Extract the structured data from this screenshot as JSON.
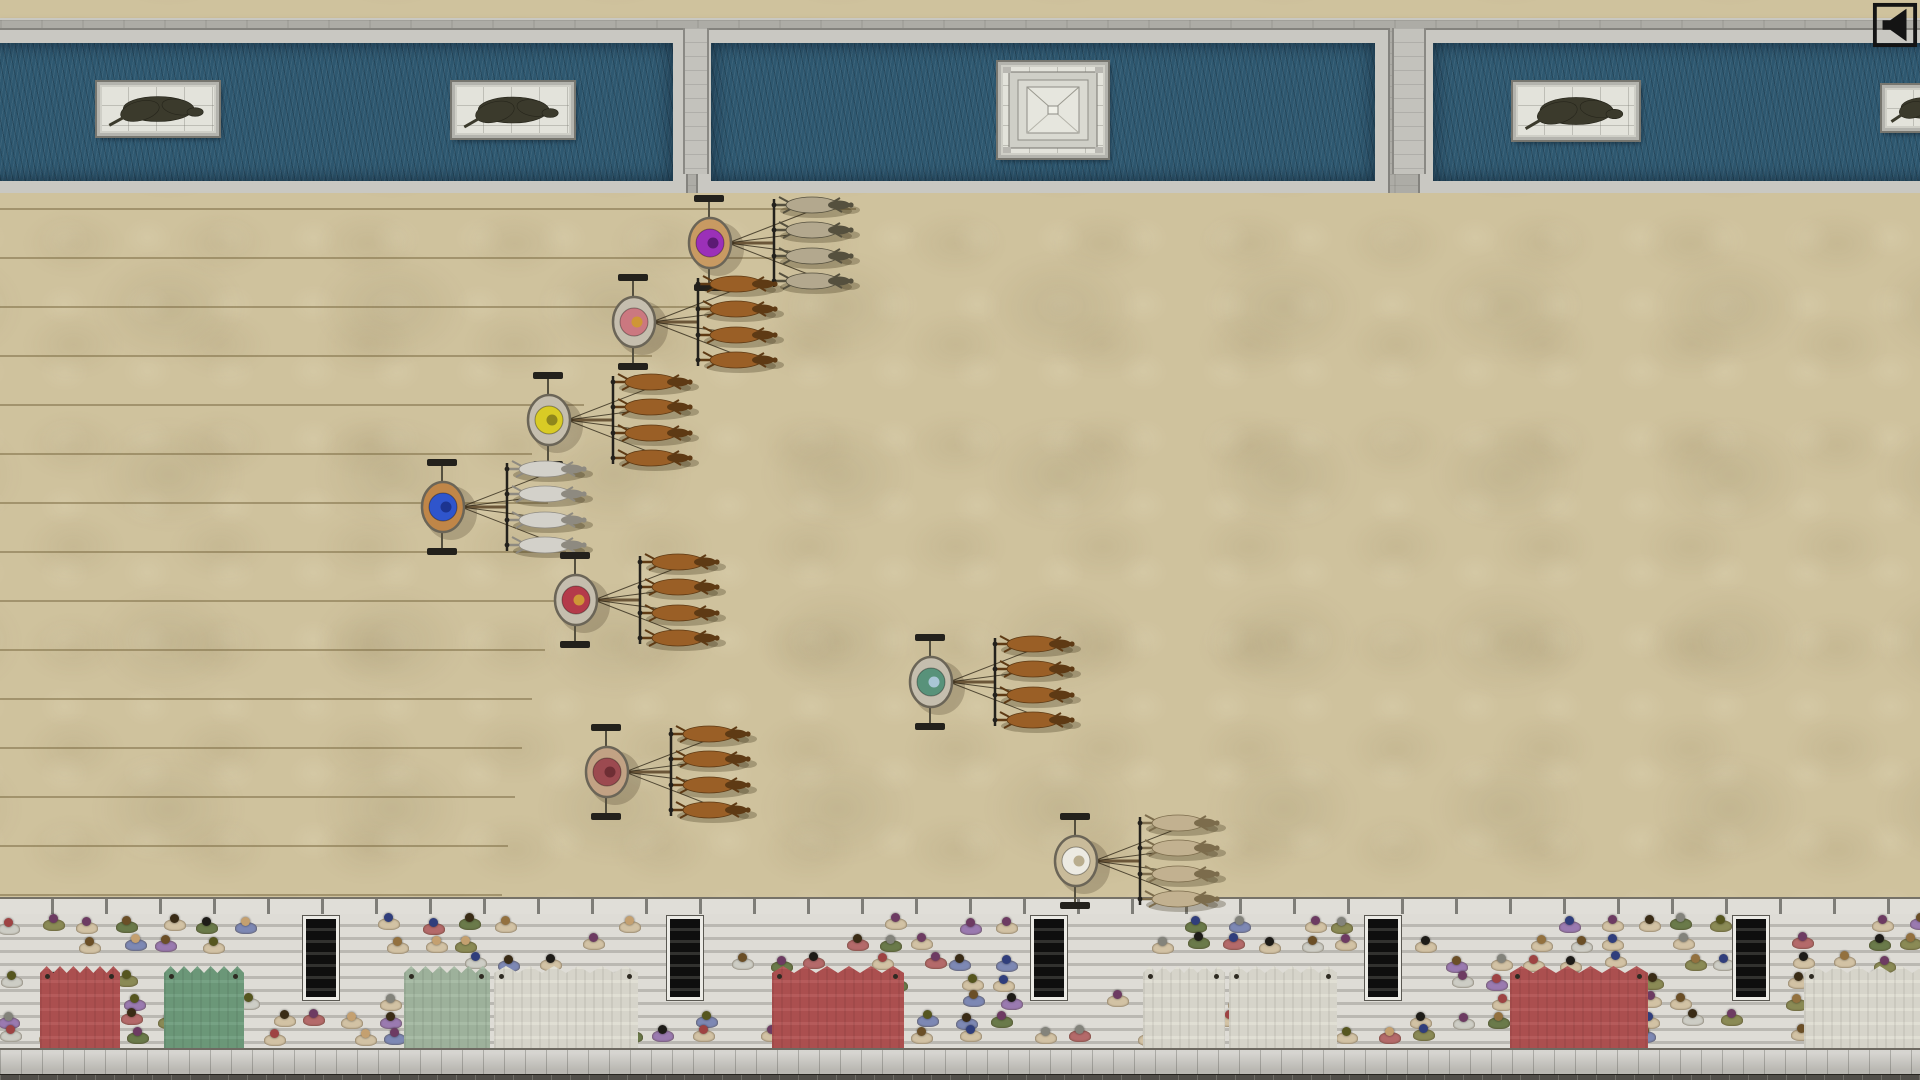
{
  "meta": {
    "scene": "top-down chariot race in a roman circus"
  },
  "colors": {
    "sand": "#cfc29d",
    "water": "#2e5870",
    "marble": "#c9c8c2",
    "spina_stone": "#adaca6",
    "stand_step": "#d7d5cf",
    "banner_red": "#b25252",
    "banner_green": "#6f9d7d",
    "banner_pale_green": "#a3b8a1",
    "banner_white": "#dfddd2",
    "statue_bronze": "#3b3a2c",
    "lane_line": "#7d6e46"
  },
  "hud": {
    "mute_button": {
      "icon": "speaker-icon",
      "x": 1872,
      "y": 2,
      "size": 46
    }
  },
  "spina": {
    "pools": [
      {
        "x": -80,
        "width": 770
      },
      {
        "x": 698,
        "width": 694
      },
      {
        "x": 1420,
        "width": 560
      }
    ],
    "junctions": [
      {
        "x": 683,
        "width": 22
      },
      {
        "x": 1392,
        "width": 30
      }
    ],
    "monuments": [
      {
        "kind": "statue",
        "name": "equestrian-statue",
        "x": 97,
        "y": 62,
        "w": 116,
        "h": 48
      },
      {
        "kind": "statue",
        "name": "standing-statue",
        "x": 452,
        "y": 62,
        "w": 116,
        "h": 50
      },
      {
        "kind": "obelisk",
        "name": "pyramid-monument",
        "x": 998,
        "y": 42,
        "w": 104,
        "h": 90
      },
      {
        "kind": "statue",
        "name": "reclining-statue",
        "x": 1513,
        "y": 62,
        "w": 120,
        "h": 52
      },
      {
        "kind": "statue",
        "name": "edge-statue",
        "x": 1882,
        "y": 65,
        "w": 80,
        "h": 40
      }
    ]
  },
  "track": {
    "lane_lines": {
      "ys": [
        208,
        257,
        306,
        355,
        404,
        453,
        502,
        551,
        600,
        649,
        698,
        747,
        796,
        845,
        894
      ],
      "end_xs": [
        856,
        788,
        720,
        652,
        584,
        532,
        548,
        566,
        584,
        545,
        532,
        522,
        515,
        508,
        502
      ]
    }
  },
  "chariots": [
    {
      "team": "purple",
      "cart_x": 710,
      "cart_y": 243,
      "driver_color": "#9b30b8",
      "head_color": "#5c1a74",
      "cart_color": "#c89a62",
      "horse_color": "#b3a88e",
      "horse_dark": "#55503e"
    },
    {
      "team": "rose",
      "cart_x": 634,
      "cart_y": 322,
      "driver_color": "#cb7880",
      "head_color": "#cf9636",
      "cart_color": "#c5beae",
      "horse_color": "#9a5f26",
      "horse_dark": "#5e3a14"
    },
    {
      "team": "yellow",
      "cart_x": 549,
      "cart_y": 420,
      "driver_color": "#d9cb25",
      "head_color": "#8f861c",
      "cart_color": "#c5beae",
      "horse_color": "#9a5f26",
      "horse_dark": "#5e3a14"
    },
    {
      "team": "blue",
      "cart_x": 443,
      "cart_y": 507,
      "driver_color": "#2f55cc",
      "head_color": "#1c3490",
      "cart_color": "#c08648",
      "horse_color": "#d3d1ca",
      "horse_dark": "#8e8a80"
    },
    {
      "team": "red",
      "cart_x": 576,
      "cart_y": 600,
      "driver_color": "#b43a4a",
      "head_color": "#cf9636",
      "cart_color": "#c5beae",
      "horse_color": "#9a5f26",
      "horse_dark": "#5e3a14"
    },
    {
      "team": "green",
      "cart_x": 931,
      "cart_y": 682,
      "driver_color": "#58927a",
      "head_color": "#a9c6d6",
      "cart_color": "#c5beae",
      "horse_color": "#9a5f26",
      "horse_dark": "#5e3a14"
    },
    {
      "team": "maroon",
      "cart_x": 607,
      "cart_y": 772,
      "driver_color": "#9c4a50",
      "head_color": "#6e2e34",
      "cart_color": "#c2a284",
      "horse_color": "#9a5f26",
      "horse_dark": "#5e3a14"
    },
    {
      "team": "white",
      "cart_x": 1076,
      "cart_y": 861,
      "driver_color": "#eceae2",
      "head_color": "#b9ad8e",
      "cart_color": "#c9bb9a",
      "horse_color": "#c2b190",
      "horse_dark": "#7c6c4c"
    }
  ],
  "stands": {
    "stairwell_xs": [
      318,
      682,
      1046,
      1380,
      1748
    ],
    "banners": [
      {
        "x": 40,
        "width": 80,
        "color": "#b25252"
      },
      {
        "x": 164,
        "width": 80,
        "color": "#6f9d7d"
      },
      {
        "x": 404,
        "width": 86,
        "color": "#a3b8a1"
      },
      {
        "x": 494,
        "width": 144,
        "color": "#dfddd2"
      },
      {
        "x": 772,
        "width": 132,
        "color": "#b25252"
      },
      {
        "x": 1143,
        "width": 82,
        "color": "#dfddd2"
      },
      {
        "x": 1229,
        "width": 108,
        "color": "#dfddd2"
      },
      {
        "x": 1510,
        "width": 138,
        "color": "#b25252"
      },
      {
        "x": 1804,
        "width": 130,
        "color": "#dfddd2"
      }
    ],
    "crowd": {
      "seed": 7,
      "row_ys": [
        2,
        21,
        40,
        59,
        78,
        97,
        113
      ],
      "x_step": 38,
      "presence": 0.58,
      "head_colors": [
        "#1e1c18",
        "#3a2c16",
        "#6b4f27",
        "#93713f",
        "#56561f",
        "#6d3b62",
        "#9e4343",
        "#303e7c",
        "#83837b",
        "#c4a070"
      ],
      "body_colors": [
        "#d2c2a4",
        "#d2c2a4",
        "#d2c2a4",
        "#d2c2a4",
        "#d2c2a4",
        "#cdcdc5",
        "#7d88b4",
        "#b46a6a",
        "#8a8a55",
        "#9a7ab0",
        "#6a7a4a"
      ]
    }
  }
}
